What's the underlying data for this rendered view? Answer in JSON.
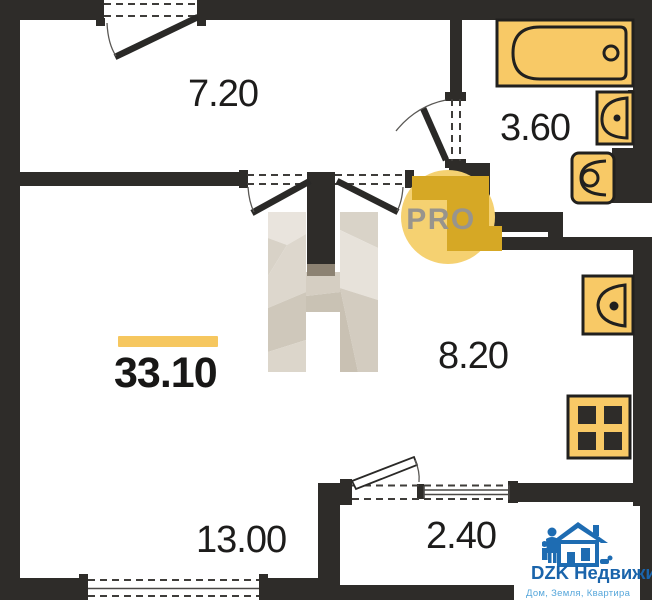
{
  "plan": {
    "total_area": "33.10",
    "rooms": [
      {
        "name": "hallway",
        "area": "7.20"
      },
      {
        "name": "bathroom",
        "area": "3.60"
      },
      {
        "name": "kitchen",
        "area": "8.20"
      },
      {
        "name": "living-room",
        "area": "13.00"
      },
      {
        "name": "balcony",
        "area": "2.40"
      }
    ],
    "badge": {
      "text": "PRO"
    },
    "logo": {
      "brand": "DZK Недвижимость",
      "tagline": "Дом, Земля, Квартира"
    },
    "colors": {
      "wall": "#2e2c29",
      "fixture_fill": "#f8c966",
      "fixture_stroke": "#21201e",
      "area_bar": "#f6c75f",
      "badge_circle": "#f5d171",
      "badge_gold": "#d6a825",
      "badge_text": "#98948d",
      "watermark_light": "#e7e2da",
      "logo_blue": "#1e6cb2",
      "logo_light_blue": "#57a7db"
    }
  }
}
